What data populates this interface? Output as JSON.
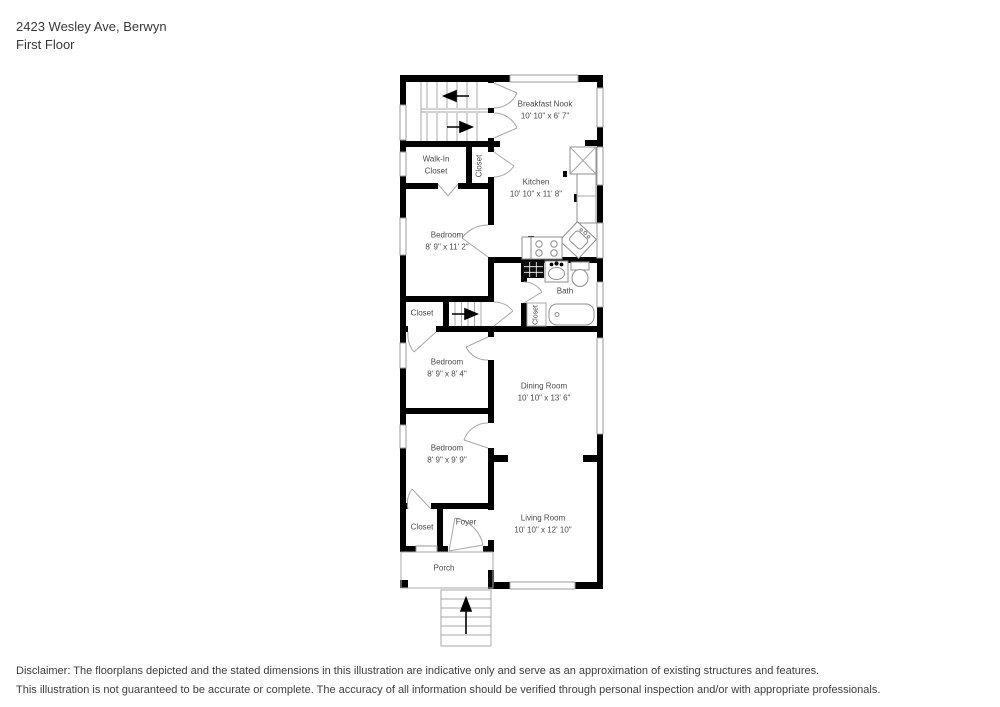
{
  "header": {
    "address": "2423 Wesley Ave, Berwyn",
    "floor": "First Floor"
  },
  "rooms": {
    "breakfast_nook": {
      "name": "Breakfast Nook",
      "dims": "10' 10\" x 6' 7\""
    },
    "kitchen": {
      "name": "Kitchen",
      "dims": "10' 10\" x 11' 8\""
    },
    "walk_in_closet": {
      "name_line1": "Walk-In",
      "name_line2": "Closet"
    },
    "closet_top": {
      "name": "Closet"
    },
    "bedroom_front": {
      "name": "Bedroom",
      "dims": "8' 9\" x 11' 2\""
    },
    "closet_mid": {
      "name": "Closet"
    },
    "bath": {
      "name": "Bath"
    },
    "bath_closet": {
      "name": "Closet"
    },
    "bedroom_middle": {
      "name": "Bedroom",
      "dims": "8' 9\" x 8' 4\""
    },
    "dining_room": {
      "name": "Dining Room",
      "dims": "10' 10\" x 13' 6\""
    },
    "bedroom_rear": {
      "name": "Bedroom",
      "dims": "8' 9\" x 9' 9\""
    },
    "closet_bottom": {
      "name": "Closet"
    },
    "foyer": {
      "name": "Foyer"
    },
    "living_room": {
      "name": "Living Room",
      "dims": "10' 10\" x 12' 10\""
    },
    "porch": {
      "name": "Porch"
    }
  },
  "disclaimer": {
    "line1": "Disclaimer: The floorplans depicted and the stated dimensions in this illustration are indicative only and serve as an approximation of existing structures and features.",
    "line2": "This illustration is not guaranteed to be accurate or complete. The accuracy of all information should be verified through personal inspection and/or with appropriate professionals."
  },
  "colors": {
    "wall": "#000000",
    "fixture_line": "#9b9b9b",
    "label_text": "#4a4a4a"
  }
}
